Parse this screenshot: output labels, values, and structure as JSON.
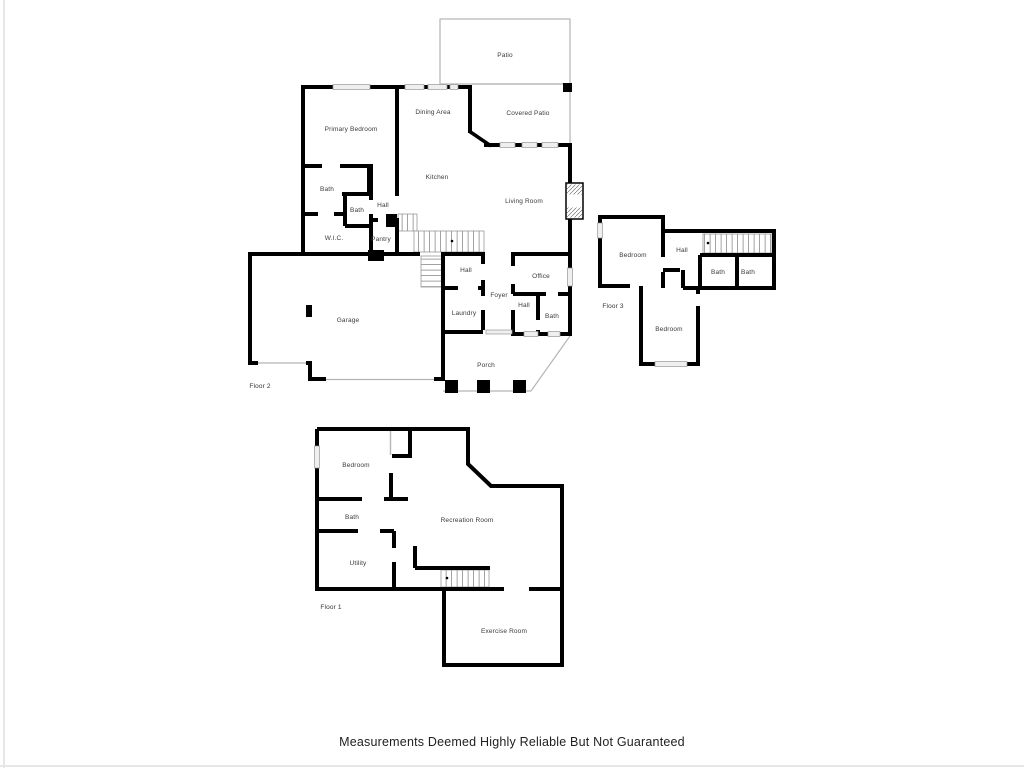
{
  "footer": {
    "disclaimer": "Measurements Deemed Highly Reliable But Not Guaranteed"
  },
  "colors": {
    "wall": "#000000",
    "thin_line": "#b5b5b5",
    "window_fill": "#efefef",
    "label_text": "#3a3a3a",
    "background": "#ffffff"
  },
  "floors": {
    "floor2": {
      "label": "Floor 2",
      "rooms": {
        "patio": "Patio",
        "covered_patio": "Covered Patio",
        "dining_area": "Dining Area",
        "primary_bedroom": "Primary Bedroom",
        "kitchen": "Kitchen",
        "living_room": "Living Room",
        "bath_primary": "Bath",
        "bath_2": "Bath",
        "hall_upper": "Hall",
        "wic": "W.I.C.",
        "pantry": "Pantry",
        "garage": "Garage",
        "hall_mid": "Hall",
        "foyer": "Foyer",
        "hall_small": "Hall",
        "office": "Office",
        "bath_office": "Bath",
        "laundry": "Laundry",
        "porch": "Porch"
      }
    },
    "floor3": {
      "label": "Floor 3",
      "rooms": {
        "bedroom_top": "Bedroom",
        "hall": "Hall",
        "bath_left": "Bath",
        "bath_right": "Bath",
        "bedroom_bottom": "Bedroom"
      }
    },
    "floor1": {
      "label": "Floor 1",
      "rooms": {
        "bedroom": "Bedroom",
        "bath": "Bath",
        "utility": "Utility",
        "recreation_room": "Recreation Room",
        "exercise_room": "Exercise Room"
      }
    }
  }
}
